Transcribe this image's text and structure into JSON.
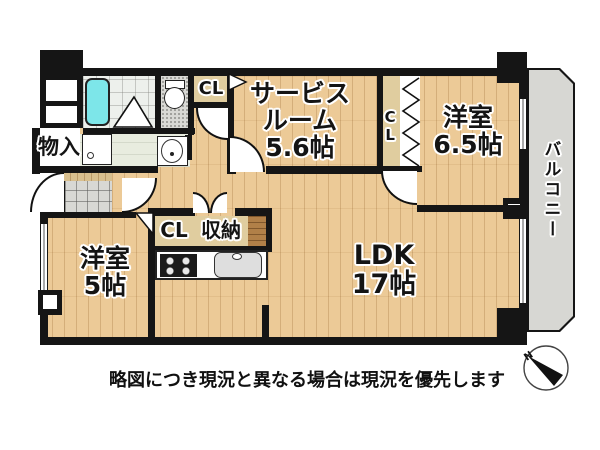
{
  "floorplan": {
    "rooms": {
      "service_room": {
        "line1": "サービス",
        "line2": "ルーム",
        "size": "5.6帖"
      },
      "bedroom_65": {
        "label": "洋室",
        "size": "6.5帖"
      },
      "bedroom_5": {
        "label": "洋室",
        "size": "5帖"
      },
      "ldk": {
        "label": "LDK",
        "size": "17帖"
      },
      "balcony": {
        "label": "バルコニー"
      }
    },
    "storage": {
      "closet_top": "CL",
      "closet_side": "CL",
      "closet_hall": "CL",
      "storage_unit": "収納",
      "mono_ire": "物入"
    },
    "compass": {
      "north_label": "N"
    },
    "colors": {
      "wood": "#ecca97",
      "wall": "#151515",
      "balcony_gray": "#d7d7d3",
      "bathtub_cyan": "#7de6e9",
      "closet_beige": "#e0cd9f",
      "tile_gray": "#d8d8d4"
    }
  },
  "caption": "略図につき現況と異なる場合は現況を優先します"
}
